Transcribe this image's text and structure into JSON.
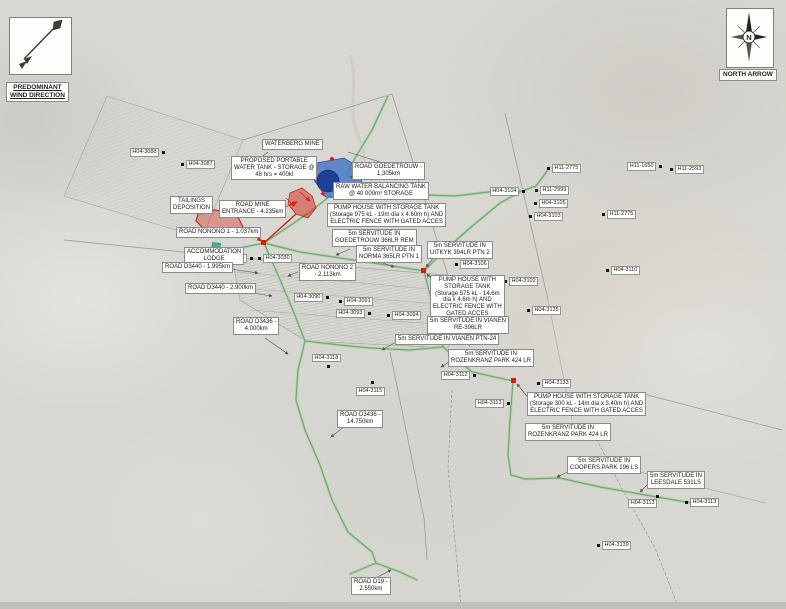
{
  "wind": {
    "line1": "PREDOMINANT",
    "line2": "WIND DIRECTION"
  },
  "north": {
    "label": "NORTH ARROW",
    "letter": "N"
  },
  "colors": {
    "map_background": "#d8d7d1",
    "road_green": "#74a874",
    "road_green_casing": "#b7d4b0",
    "boundary_gray": "#95958f",
    "tailings_red": "#cf2318",
    "junction_red": "#e8150a",
    "tank_blue": "#4a78c8",
    "tank_blue_dark": "#1e3f97",
    "lodge_teal": "#49b0a0",
    "label_border": "#8b8b87"
  },
  "map": {
    "annotations": [
      {
        "id": "waterberg-mine",
        "x": 262,
        "y": 139,
        "lines": [
          "WATERBERG MINE"
        ]
      },
      {
        "id": "proposed-portable-water-tank",
        "x": 231,
        "y": 156,
        "lines": [
          "PROPOSED PORTABLE",
          "WATER TANK - STORAGE @",
          "48 hrs = 400kl"
        ]
      },
      {
        "id": "road-goedetrouw",
        "x": 352,
        "y": 162,
        "lines": [
          "ROAD GOEDETROUW -",
          "1,305km"
        ]
      },
      {
        "id": "raw-water-balancing-tank",
        "x": 333,
        "y": 182,
        "lines": [
          "RAW WATER BALANCING TANK",
          "@ 40 000m³ STORAGE"
        ]
      },
      {
        "id": "pump-house-975",
        "x": 327,
        "y": 203,
        "lines": [
          "PUMP HOUSE WITH STORAGE TANK",
          "(Storage 975 kL - 19m dia x 4.60m h) AND",
          "ELECTRIC FENCE WITH GATED ACCES"
        ]
      },
      {
        "id": "tailings-deposition",
        "x": 170,
        "y": 196,
        "lines": [
          "TAILINGS",
          "DEPOSITION"
        ]
      },
      {
        "id": "road-mine-entrance",
        "x": 219,
        "y": 200,
        "lines": [
          "ROAD MINE",
          "ENTRANCE - 4.235km"
        ]
      },
      {
        "id": "servitude-goedetrouw",
        "x": 332,
        "y": 229,
        "lines": [
          "5m SERVITUDE IN",
          "GOEDETROUW 366LR REM"
        ]
      },
      {
        "id": "road-nonono-1",
        "x": 176,
        "y": 227,
        "lines": [
          "ROAD NONONO 1 - 1.037km"
        ]
      },
      {
        "id": "accommodation-lodge",
        "x": 184,
        "y": 247,
        "lines": [
          "ACCOMMODATION",
          "LODGE"
        ]
      },
      {
        "id": "servitude-norma",
        "x": 356,
        "y": 245,
        "lines": [
          "5m SERVITUDE IN",
          "NORMA 365LR PTN 1"
        ]
      },
      {
        "id": "servitude-uitkyk",
        "x": 427,
        "y": 241,
        "lines": [
          "5m SERVITUDE IN",
          "UITKYK 394LR PTN 2"
        ]
      },
      {
        "id": "road-nonono-2",
        "x": 299,
        "y": 263,
        "lines": [
          "ROAD NONONO 2",
          "- 2.113km"
        ]
      },
      {
        "id": "road-d3440-1995",
        "x": 162,
        "y": 262,
        "lines": [
          "ROAD D3440 - 1.995km"
        ]
      },
      {
        "id": "road-d3440-2900",
        "x": 185,
        "y": 283,
        "lines": [
          "ROAD D3440 - 2.900km"
        ]
      },
      {
        "id": "pump-house-575",
        "x": 430,
        "y": 275,
        "lines": [
          "PUMP HOUSE WITH",
          "STORAGE TANK",
          "(Storage 575 kL - 14.6m",
          "dia x 4.6m h) AND",
          "ELECTRIC FENCE WITH",
          "GATED ACCES"
        ]
      },
      {
        "id": "road-d3436-4000",
        "x": 233,
        "y": 317,
        "lines": [
          "ROAD D3436 -",
          "4.000km"
        ]
      },
      {
        "id": "servitude-vianen-re",
        "x": 427,
        "y": 316,
        "lines": [
          "5m SERVITUDE IN VIANEN",
          "RE-396LR"
        ]
      },
      {
        "id": "servitude-vianen-ptn24",
        "x": 395,
        "y": 334,
        "lines": [
          "5m SERVITUDE IN VIANEN PTN-24"
        ]
      },
      {
        "id": "servitude-rozenkranz-1",
        "x": 448,
        "y": 349,
        "lines": [
          "5m SERVITUDE IN",
          "ROZENKRANZ PARK 424 LR"
        ]
      },
      {
        "id": "road-d3436-14750",
        "x": 337,
        "y": 410,
        "lines": [
          "ROAD D3436 -",
          "14.750km"
        ]
      },
      {
        "id": "pump-house-300",
        "x": 527,
        "y": 392,
        "lines": [
          "PUMP HOUSE WITH STORAGE TANK",
          "(Storage 300 kL - 14m dia x 3.40m h) AND",
          "ELECTRIC FENCE WITH GATED ACCES"
        ]
      },
      {
        "id": "servitude-rozenkranz-2",
        "x": 525,
        "y": 423,
        "lines": [
          "5m SERVITUDE IN",
          "ROZENKRANZ PARK 424 LR"
        ]
      },
      {
        "id": "servitude-coopers",
        "x": 567,
        "y": 456,
        "lines": [
          "5m SERVITUDE IN",
          "COOPERS PARK 196 LS"
        ]
      },
      {
        "id": "servitude-leesdale",
        "x": 647,
        "y": 471,
        "lines": [
          "5m SERVITUDE IN",
          "LEESDALE 531LS"
        ]
      },
      {
        "id": "road-d19",
        "x": 351,
        "y": 577,
        "lines": [
          "ROAD D19 -",
          "2.550km"
        ]
      }
    ],
    "markers": [
      {
        "label": "H04-3088",
        "x": 163,
        "y": 152,
        "side": "left"
      },
      {
        "label": "H04-3087",
        "x": 182,
        "y": 164,
        "side": "right"
      },
      {
        "label": "H04-3089",
        "x": 251,
        "y": 258,
        "side": "left"
      },
      {
        "label": "H04-3030",
        "x": 259,
        "y": 258,
        "side": "right"
      },
      {
        "label": "H04-3090",
        "x": 327,
        "y": 297,
        "side": "left"
      },
      {
        "label": "H04-3091",
        "x": 340,
        "y": 301,
        "side": "right"
      },
      {
        "label": "H04-3093",
        "x": 369,
        "y": 313,
        "side": "left"
      },
      {
        "label": "H04-3094",
        "x": 388,
        "y": 315,
        "side": "right"
      },
      {
        "label": "H04-3104",
        "x": 523,
        "y": 191,
        "side": "left"
      },
      {
        "label": "H11-2999",
        "x": 536,
        "y": 190,
        "side": "right"
      },
      {
        "label": "H04-3105",
        "x": 535,
        "y": 203,
        "side": "right"
      },
      {
        "label": "H04-3103",
        "x": 530,
        "y": 216,
        "side": "right"
      },
      {
        "label": "H11-2775",
        "x": 548,
        "y": 168,
        "side": "right"
      },
      {
        "label": "H11-1650",
        "x": 660,
        "y": 166,
        "side": "left"
      },
      {
        "label": "H11-2593",
        "x": 671,
        "y": 169,
        "side": "right"
      },
      {
        "label": "H11-2775",
        "x": 603,
        "y": 214,
        "side": "right"
      },
      {
        "label": "H04-3110",
        "x": 607,
        "y": 270,
        "side": "right"
      },
      {
        "label": "H04-3106",
        "x": 456,
        "y": 264,
        "side": "right"
      },
      {
        "label": "H04-3102",
        "x": 505,
        "y": 281,
        "side": "right"
      },
      {
        "label": "H04-3135",
        "x": 528,
        "y": 310,
        "side": "right"
      },
      {
        "label": "H04-3118",
        "x": 328,
        "y": 366,
        "side": "above"
      },
      {
        "label": "H04-3115",
        "x": 372,
        "y": 382,
        "side": "below"
      },
      {
        "label": "H04-3112",
        "x": 474,
        "y": 375,
        "side": "left"
      },
      {
        "label": "H04-3133",
        "x": 538,
        "y": 383,
        "side": "right"
      },
      {
        "label": "H04-3113",
        "x": 508,
        "y": 403,
        "side": "left"
      },
      {
        "label": "H04-3113",
        "x": 657,
        "y": 496,
        "side": "below-left"
      },
      {
        "label": "H04-3113",
        "x": 686,
        "y": 502,
        "side": "right"
      },
      {
        "label": "H04-3139",
        "x": 598,
        "y": 545,
        "side": "right"
      }
    ]
  }
}
